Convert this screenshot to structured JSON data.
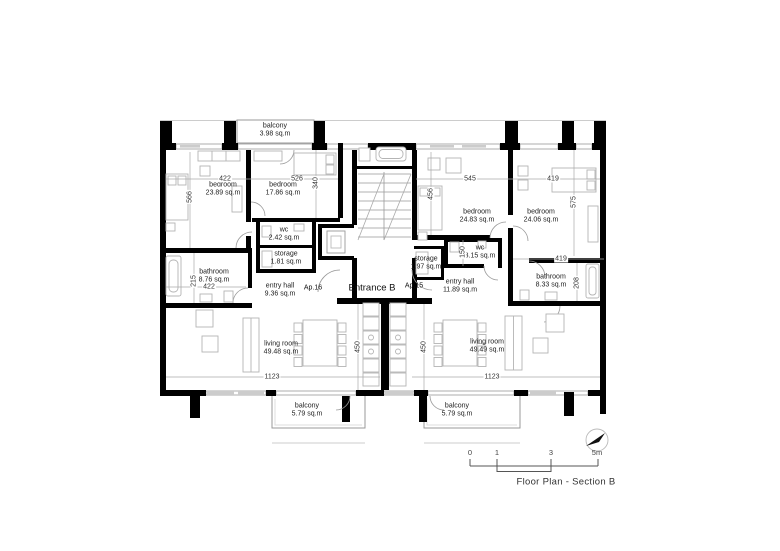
{
  "drawing": {
    "title": "Floor Plan - Section B",
    "entrance": "Entrance B",
    "apartment_left": "Ap.16",
    "apartment_right": "Ap.15"
  },
  "rooms": [
    {
      "name": "balcony",
      "area": "3.98 sq.m"
    },
    {
      "name": "bedroom",
      "area": "23.89 sq.m"
    },
    {
      "name": "bedroom",
      "area": "17.86 sq.m"
    },
    {
      "name": "wc",
      "area": "2.42 sq.m"
    },
    {
      "name": "storage",
      "area": "1.81 sq.m"
    },
    {
      "name": "bathroom",
      "area": "8.76 sq.m"
    },
    {
      "name": "entry hall",
      "area": "9.36 sq.m"
    },
    {
      "name": "living room",
      "area": "49.48 sq.m"
    },
    {
      "name": "balcony",
      "area": "5.79 sq.m"
    },
    {
      "name": "bedroom",
      "area": "24.83 sq.m"
    },
    {
      "name": "bedroom",
      "area": "24.06 sq.m"
    },
    {
      "name": "wc",
      "area": "3.15 sq.m"
    },
    {
      "name": "storage",
      "area": "1.97 sq.m"
    },
    {
      "name": "entry hall",
      "area": "11.89 sq.m"
    },
    {
      "name": "bathroom",
      "area": "8.33 sq.m"
    },
    {
      "name": "living room",
      "area": "49.49 sq.m"
    },
    {
      "name": "balcony",
      "area": "5.79 sq.m"
    }
  ],
  "dimensions": [
    "422",
    "526",
    "340",
    "566",
    "215",
    "422",
    "545",
    "419",
    "456",
    "575",
    "150",
    "419",
    "208",
    "1123",
    "450",
    "450",
    "1123"
  ],
  "scale_bar": {
    "ticks": [
      "0",
      "1",
      "3",
      "5m"
    ]
  },
  "colors": {
    "wall": "#000000",
    "thin_line": "#999999",
    "furniture": "#b4b4b4"
  }
}
